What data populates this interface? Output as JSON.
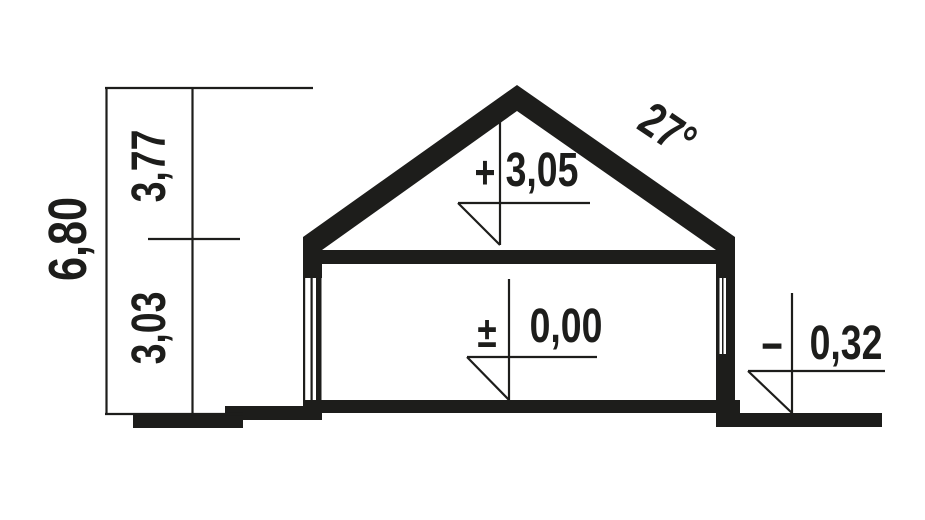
{
  "drawing": {
    "type": "house-cross-section",
    "colors": {
      "ink": "#1d1d1b",
      "background": "#ffffff"
    }
  },
  "dimensions": {
    "total_height": "6,80",
    "upper_storey_height": "3,77",
    "ground_storey_height": "3,03"
  },
  "roof": {
    "angle_label": "27°"
  },
  "levels": [
    {
      "name": "attic-floor-level",
      "sign": "+",
      "value": "3,05"
    },
    {
      "name": "ground-floor-level",
      "sign": "±",
      "value": "0,00"
    },
    {
      "name": "terrain-level",
      "sign": "−",
      "value": "0,32"
    }
  ]
}
